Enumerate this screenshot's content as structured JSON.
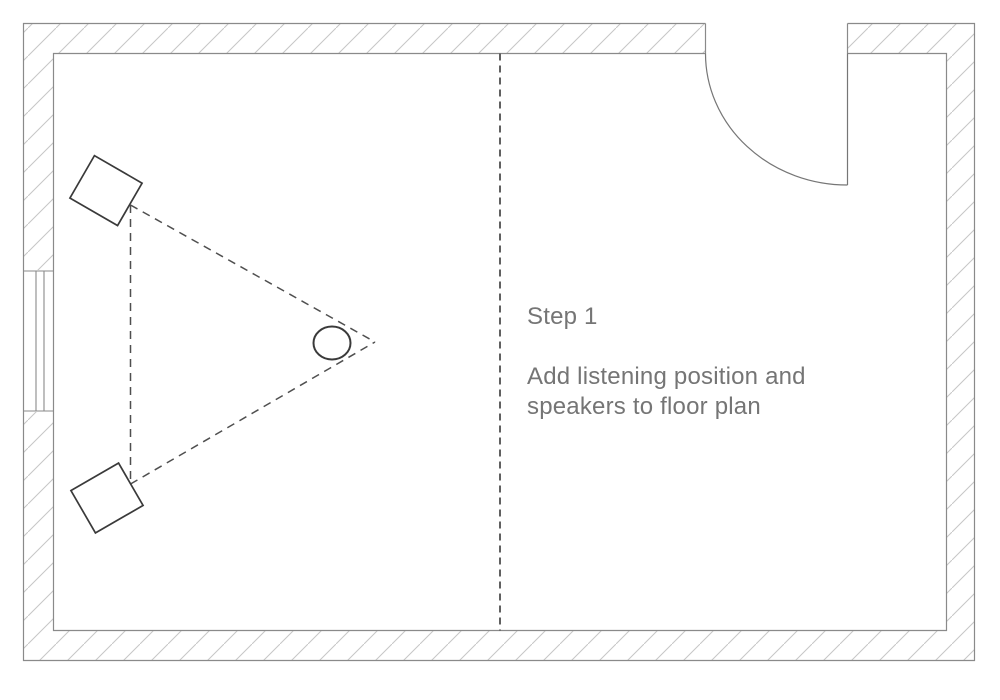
{
  "annotation": {
    "step_label": "Step 1",
    "instruction_line1": "Add listening position and",
    "instruction_line2": "speakers to floor plan"
  },
  "floor_plan": {
    "colors": {
      "background": "#ffffff",
      "hatch": "#c6c6c6",
      "wall_line": "#8a8a8a",
      "window_line": "#8a8a8a",
      "door_line": "#767676",
      "dashed_line": "#4f4f4f",
      "object_line": "#3a3a3a",
      "text": "#757575"
    },
    "elements": {
      "room": "rectangular-room-hatched-walls",
      "door": "door-swing-top-right",
      "window": "window-left-wall",
      "divider": "room-divider-dashed-line",
      "triangle": "stereo-triangle-dashed",
      "speakers": [
        "left-top-speaker",
        "left-bottom-speaker"
      ],
      "listening_position": "listening-position-circle"
    }
  }
}
